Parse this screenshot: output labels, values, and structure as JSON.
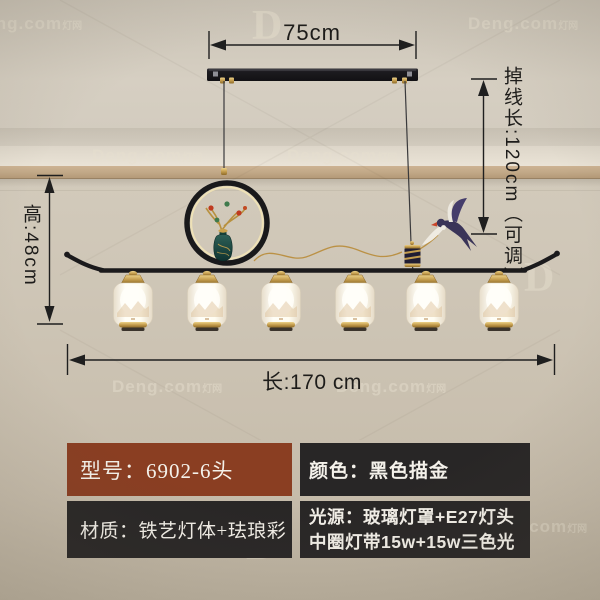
{
  "product_diagram": {
    "dimensions": {
      "mount_width": "75cm",
      "drop_length": "掉线长:120cm（可调）",
      "fixture_height": "高:48cm",
      "fixture_length": "长:170 cm"
    },
    "specs": {
      "model": "型号：6902-6头",
      "color": "颜色：黑色描金",
      "material": "材质：铁艺灯体+珐琅彩",
      "light_source_line1": "光源：玻璃灯罩+E27灯头",
      "light_source_line2": "中圈灯带15w+15w三色光"
    },
    "watermark": {
      "brand": "Deng.com",
      "suffix": "灯网",
      "logo": "D",
      "text_positions": [
        {
          "x": -28,
          "y": 14
        },
        {
          "x": 468,
          "y": 14
        },
        {
          "x": 92,
          "y": 146
        },
        {
          "x": 287,
          "y": 146
        },
        {
          "x": 112,
          "y": 377
        },
        {
          "x": 336,
          "y": 377
        },
        {
          "x": 477,
          "y": 517
        }
      ],
      "logo_positions": [
        {
          "x": 252,
          "y": 2
        },
        {
          "x": 524,
          "y": 254
        },
        {
          "x": 246,
          "y": 522
        }
      ]
    },
    "lamp": {
      "shade_count": 6,
      "shade_positions": [
        133,
        207,
        281,
        355,
        426,
        499
      ]
    },
    "colors": {
      "model_box": "#8a3e22",
      "spec_box": "#282626",
      "gold": "#c9a24a",
      "frame_black": "#1b1a1c",
      "wall": "#cdc4b4",
      "shade_white": "#fffdf4"
    }
  }
}
